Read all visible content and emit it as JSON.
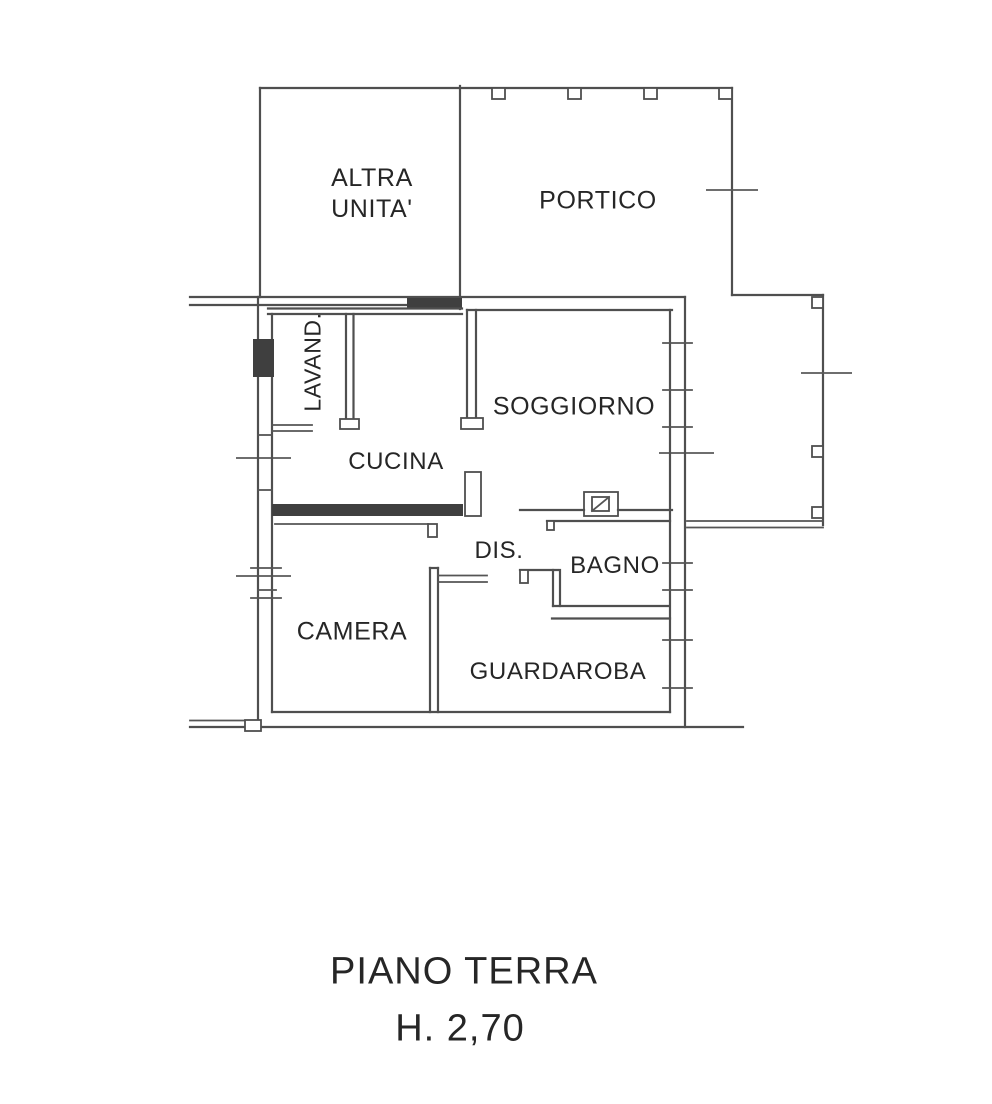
{
  "plan": {
    "rooms": {
      "altra_unita": {
        "line1": "ALTRA",
        "line2": "UNITA'"
      },
      "portico": "PORTICO",
      "lavanderia": "LAVAND.",
      "soggiorno": "SOGGIORNO",
      "cucina": "CUCINA",
      "disimpegno": "DIS.",
      "bagno": "BAGNO",
      "camera": "CAMERA",
      "guardaroba": "GUARDAROBA"
    },
    "footer": {
      "floor_label": "PIANO TERRA",
      "height_label": "H. 2,70"
    },
    "colors": {
      "line": "#4f4f4f",
      "dark_fill": "#3f3f3f",
      "text": "#262626",
      "background": "#ffffff"
    }
  }
}
